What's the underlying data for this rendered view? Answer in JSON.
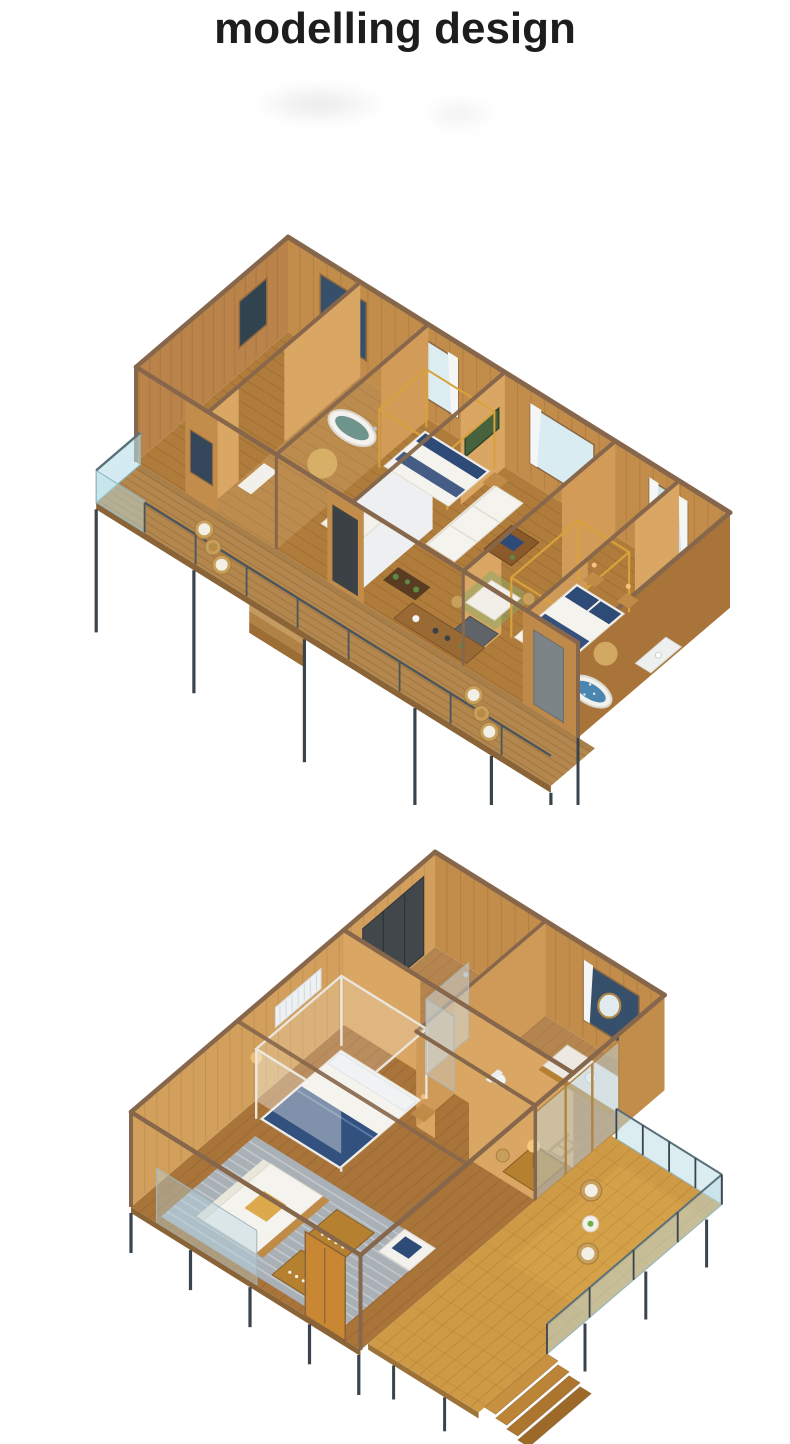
{
  "header": {
    "title": "modelling design"
  },
  "figures": [
    {
      "id": "render-top",
      "alt": "3D isometric cutaway model of a long prefab cabin: bedrooms with canopy beds, oval soaking tub, blue mosaic tub, living and dining room, kitchen, and a full-length front deck with wicker seating on dark steel stilts"
    },
    {
      "id": "render-bottom",
      "alt": "3D isometric cutaway model of a smaller prefab cabin: canopy bed, living room with sofa and grey rug, bathroom with round mirror and vanity, glass shower, wardrobe, and a large sunny corner deck with wicker chairs, glass railing and timber steps"
    }
  ],
  "palette": {
    "title_text": "#1d1d1f",
    "background": "#ffffff",
    "wood_floor": "#a9743a",
    "wood_wall": "#c28c4b",
    "wood_wall_light": "#d9a763",
    "beam_brown": "#87674b",
    "deck_wood": "#b3874d",
    "deck_wood_bright": "#cf9a45",
    "glass_blue": "#b5dee8",
    "steel_dark": "#3a444c",
    "soft_white": "#f5f3ee",
    "navy": "#2e4a77",
    "canopy_gold": "#d9a13b",
    "tub_blue": "#4a86b0",
    "rug_gray": "#a9b3bd",
    "rug_tan": "#d9b36a",
    "plant_green": "#5d8a46"
  }
}
